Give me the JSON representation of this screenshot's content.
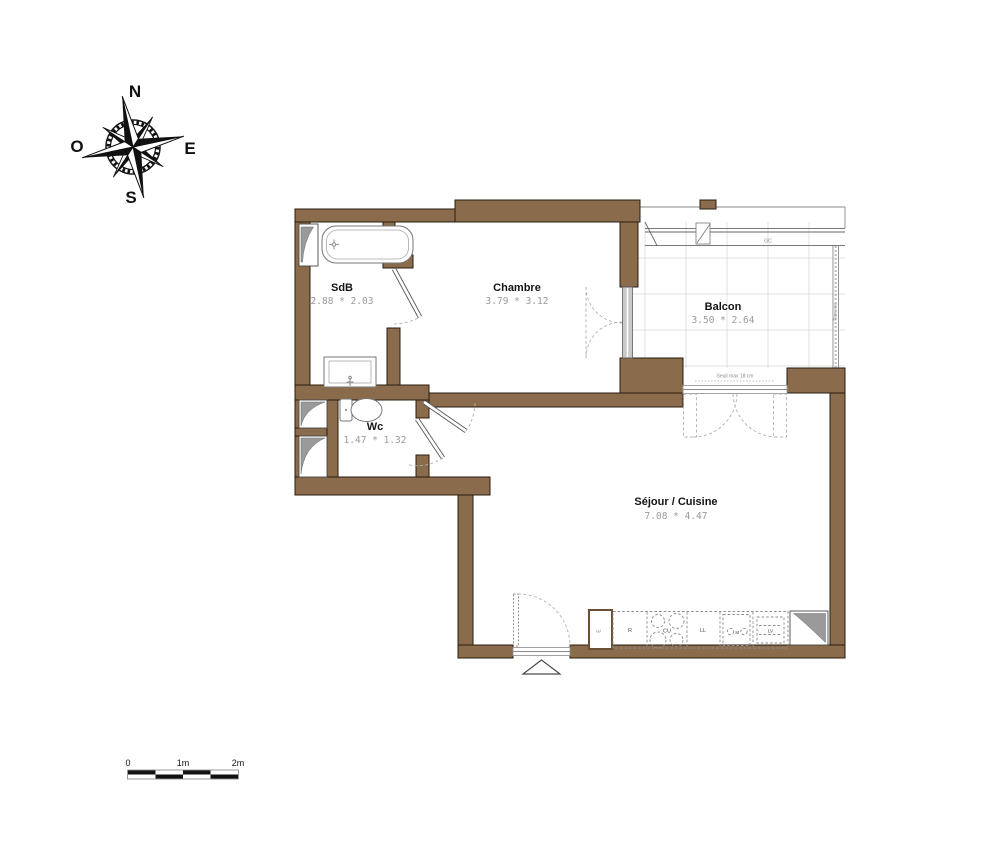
{
  "compass": {
    "north": "N",
    "east": "E",
    "south": "S",
    "west": "O"
  },
  "rooms": {
    "sdb": {
      "name": "SdB",
      "dims": "2.88 * 2.03"
    },
    "chambre": {
      "name": "Chambre",
      "dims": "3.79 * 3.12"
    },
    "balcon": {
      "name": "Balcon",
      "dims": "3.50 * 2.64"
    },
    "wc": {
      "name": "Wc",
      "dims": "1.47 * 1.32"
    },
    "sejour": {
      "name": "Séjour / Cuisine",
      "dims": "7.08 * 4.47"
    }
  },
  "balcony": {
    "railing_label": "GC",
    "threshold_label": "Seuil max 18 cm",
    "privacy_screen_label": "Pare vue"
  },
  "kitchen": {
    "fridge": "R",
    "cooktop": "CU",
    "washer": "LL",
    "mixer": "M",
    "dishwasher": "LV",
    "duct": "E"
  },
  "scale_bar": {
    "zero": "0",
    "one": "1m",
    "two": "2m"
  },
  "colors": {
    "wall": "#8a6b4c",
    "dim_text": "#9b9b9b",
    "swing": "#b0b0b0"
  }
}
